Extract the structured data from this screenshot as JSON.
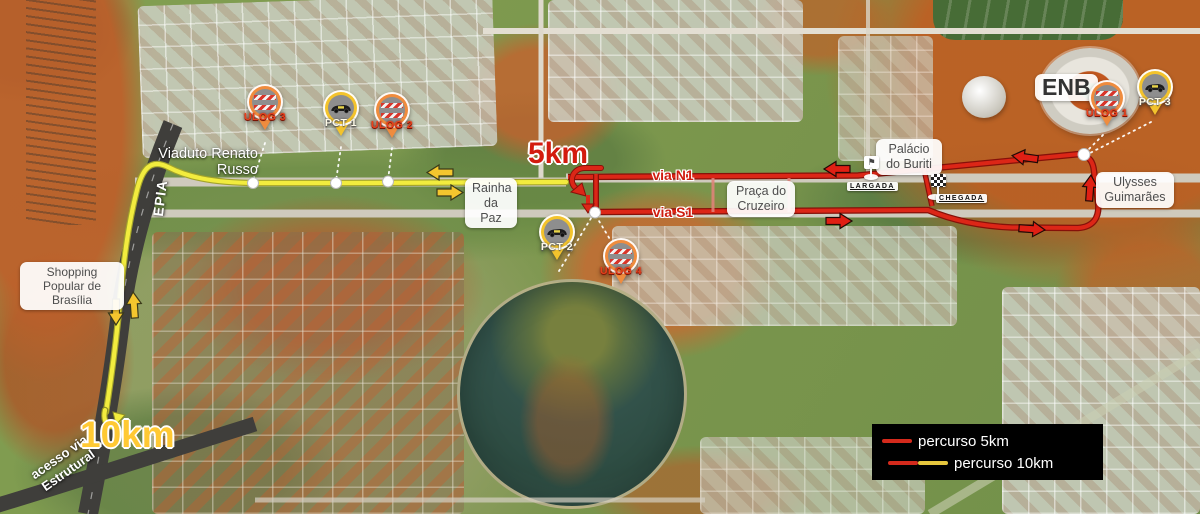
{
  "labels": {
    "viaduto_renato_russo": "Viaduto Renato Russo",
    "epia": "EPIA",
    "rainha_da_paz": "Rainha da Paz",
    "shopping_popular": "Shopping Popular de Brasília",
    "praca_do_cruzeiro": "Praça do Cruzeiro",
    "palacio_do_buriti": "Palácio do Buriti",
    "ulysses_guimaraes": "Ulysses Guimarães",
    "enb": "ENB",
    "acesso_via_estrutural": "acesso via Estrutural",
    "via_n1": "via N1",
    "via_s1": "via S1",
    "marker_5km": "5km",
    "marker_10km": "10km",
    "largada": "LARGADA",
    "chegada": "CHEGADA",
    "largada_flag_glyph": "⚑"
  },
  "pins": [
    {
      "id": "ulog-3",
      "label": "ULOG 3",
      "type": "barrier"
    },
    {
      "id": "pct-1",
      "label": "PCT 1",
      "type": "car"
    },
    {
      "id": "ulog-2",
      "label": "ULOG 2",
      "type": "barrier"
    },
    {
      "id": "pct-2",
      "label": "PCT 2",
      "type": "car"
    },
    {
      "id": "ulog-4",
      "label": "ULOG 4",
      "type": "barrier"
    },
    {
      "id": "ulog-1",
      "label": "ULOG 1",
      "type": "barrier"
    },
    {
      "id": "pct-3",
      "label": "PCT 3",
      "type": "car"
    }
  ],
  "legend": {
    "items": [
      {
        "label": "percurso 5km",
        "colors": [
          "#d42a1c"
        ]
      },
      {
        "label": "percurso 10km",
        "colors": [
          "#d42a1c",
          "#e6c63d"
        ]
      }
    ]
  },
  "colors": {
    "route_5km": "#d42a1c",
    "route_10km": "#f2ec3e",
    "pin_orange": "#ef8c3e",
    "pin_yellow": "#f3c32c",
    "legend_background": "#000000"
  }
}
